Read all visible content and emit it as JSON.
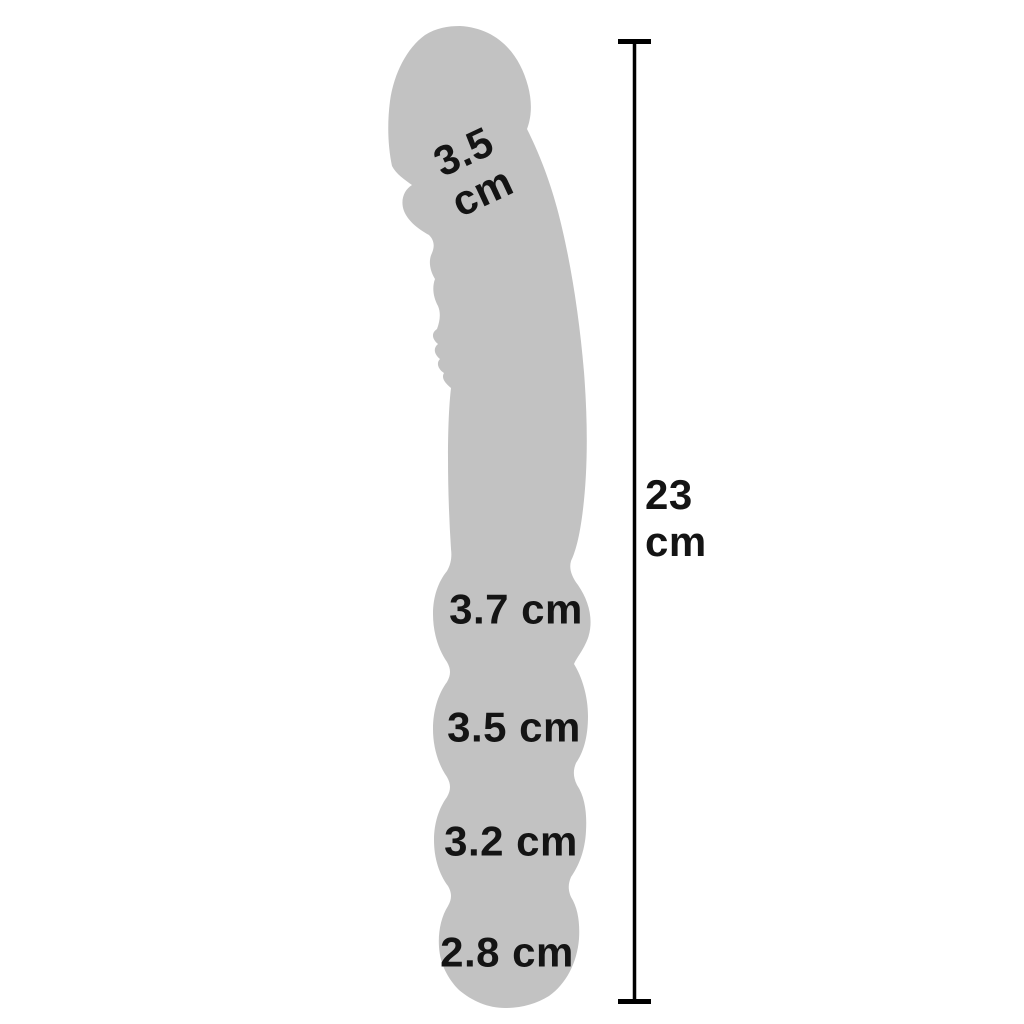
{
  "diagram": {
    "type": "product-dimension-diagram",
    "background_color": "#ffffff",
    "silhouette_color": "#c2c2c2",
    "text_color": "#141414",
    "line_color": "#000000",
    "unit": "cm",
    "total_length_label": "23\ncm",
    "head_diameter_label": "3.5\ncm",
    "bead_labels": [
      "3.7 cm",
      "3.5 cm",
      "3.2 cm",
      "2.8 cm"
    ],
    "measurements": {
      "total_length_cm": 23,
      "head_diameter_cm": 3.5,
      "bead_diameters_cm": [
        3.7,
        3.5,
        3.2,
        2.8
      ]
    }
  }
}
